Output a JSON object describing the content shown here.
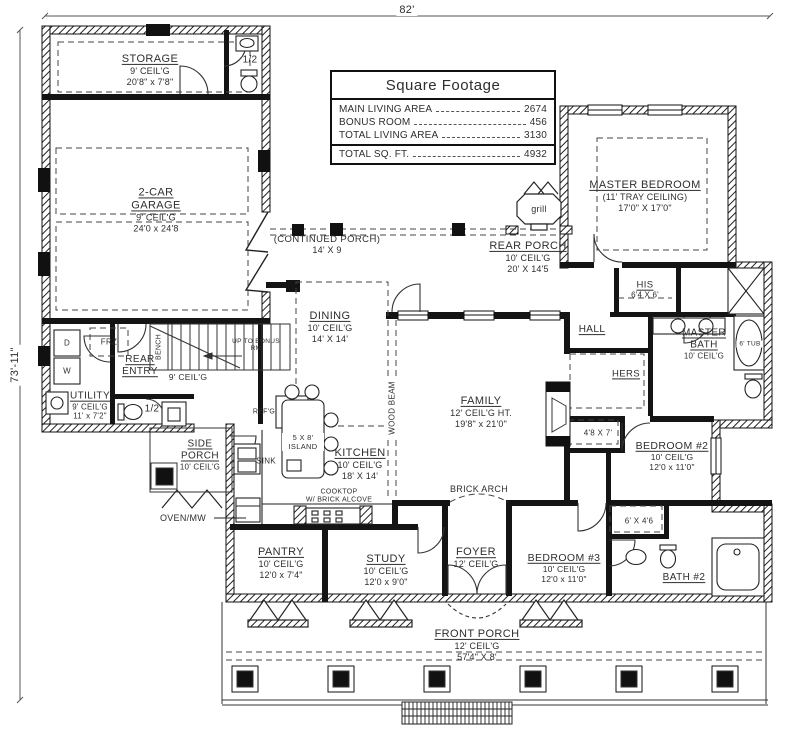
{
  "dimensions": {
    "width_label": "82'",
    "height_label": "73'-11\""
  },
  "square_footage": {
    "title": "Square Footage",
    "rows": [
      {
        "label": "MAIN LIVING AREA",
        "value": "2674"
      },
      {
        "label": "BONUS ROOM",
        "value": "456"
      },
      {
        "label": "TOTAL LIVING AREA",
        "value": "3130"
      }
    ],
    "total": {
      "label": "TOTAL SQ. FT.",
      "value": "4932"
    }
  },
  "rooms": {
    "storage": {
      "name": "STORAGE",
      "ceiling": "9' CEIL'G",
      "size": "20'8\" x 7'8\""
    },
    "garage": {
      "name": "2-CAR GARAGE",
      "ceiling": "9' CEIL'G",
      "size": "24'0 x 24'8"
    },
    "master_bedroom": {
      "name": "MASTER BEDROOM",
      "ceiling": "(11' TRAY CEILING)",
      "size": "17'0\" X 17'0\""
    },
    "continued_porch": {
      "name": "(CONTINUED PORCH)",
      "size": "14' X 9"
    },
    "rear_porch": {
      "name": "REAR PORCH",
      "ceiling": "10' CEIL'G",
      "size": "20' X 14'5"
    },
    "dining": {
      "name": "DINING",
      "ceiling": "10' CEIL'G",
      "size": "14' X 14'"
    },
    "rear_entry": {
      "name": "REAR ENTRY"
    },
    "utility": {
      "name": "UTILITY",
      "ceiling": "9' CEIL'G",
      "size": "11' x 7'2\""
    },
    "side_porch": {
      "name": "SIDE PORCH",
      "ceiling": "10' CEIL'G"
    },
    "kitchen": {
      "name": "KITCHEN",
      "ceiling": "10' CEIL'G",
      "size": "18' X 14'"
    },
    "family": {
      "name": "FAMILY",
      "ceiling": "12' CEIL'G HT.",
      "size": "19'8\" x 21'0\""
    },
    "hall": {
      "name": "HALL"
    },
    "his": {
      "name": "HIS",
      "size": "6'4 X 6'"
    },
    "hers": {
      "name": "HERS"
    },
    "master_bath": {
      "name": "MASTER BATH",
      "ceiling": "10' CEIL'G"
    },
    "bedroom2": {
      "name": "BEDROOM #2",
      "ceiling": "10' CEIL'G",
      "size": "12'0 x 11'0\""
    },
    "bedroom3": {
      "name": "BEDROOM #3",
      "ceiling": "10' CEIL'G",
      "size": "12'0 x 11'0\""
    },
    "bath2": {
      "name": "BATH #2"
    },
    "foyer": {
      "name": "FOYER",
      "ceiling": "12' CEIL'G"
    },
    "study": {
      "name": "STUDY",
      "ceiling": "10' CEIL'G",
      "size": "12'0 x 9'0\""
    },
    "pantry": {
      "name": "PANTRY",
      "ceiling": "10' CEIL'G",
      "size": "12'0 x 7'4\""
    },
    "front_porch": {
      "name": "FRONT PORCH",
      "ceiling": "12' CEIL'G",
      "size": "57'4\" X 8'"
    }
  },
  "labels": {
    "half_bath": "1/2",
    "half_bath2": "1/2",
    "grill": "grill",
    "up_to_bonus": "UP TO BONUS RM",
    "bench": "BENCH",
    "ceil9": "9' CEIL'G",
    "frz": "FRZ",
    "dryer": "D",
    "washer": "W",
    "island": "5 X 8' ISLAND",
    "sink": "SINK",
    "refg": "REF'G",
    "wood_beam": "WOOD BEAM",
    "cooktop": "COOKTOP",
    "cooktop2": "W/ BRICK ALCOVE",
    "oven_mw": "OVEN/MW",
    "tub": "6' TUB",
    "closet_a": "4'8 X 7'",
    "closet_b": "6' X 4'6",
    "brick_arch": "BRICK ARCH"
  }
}
